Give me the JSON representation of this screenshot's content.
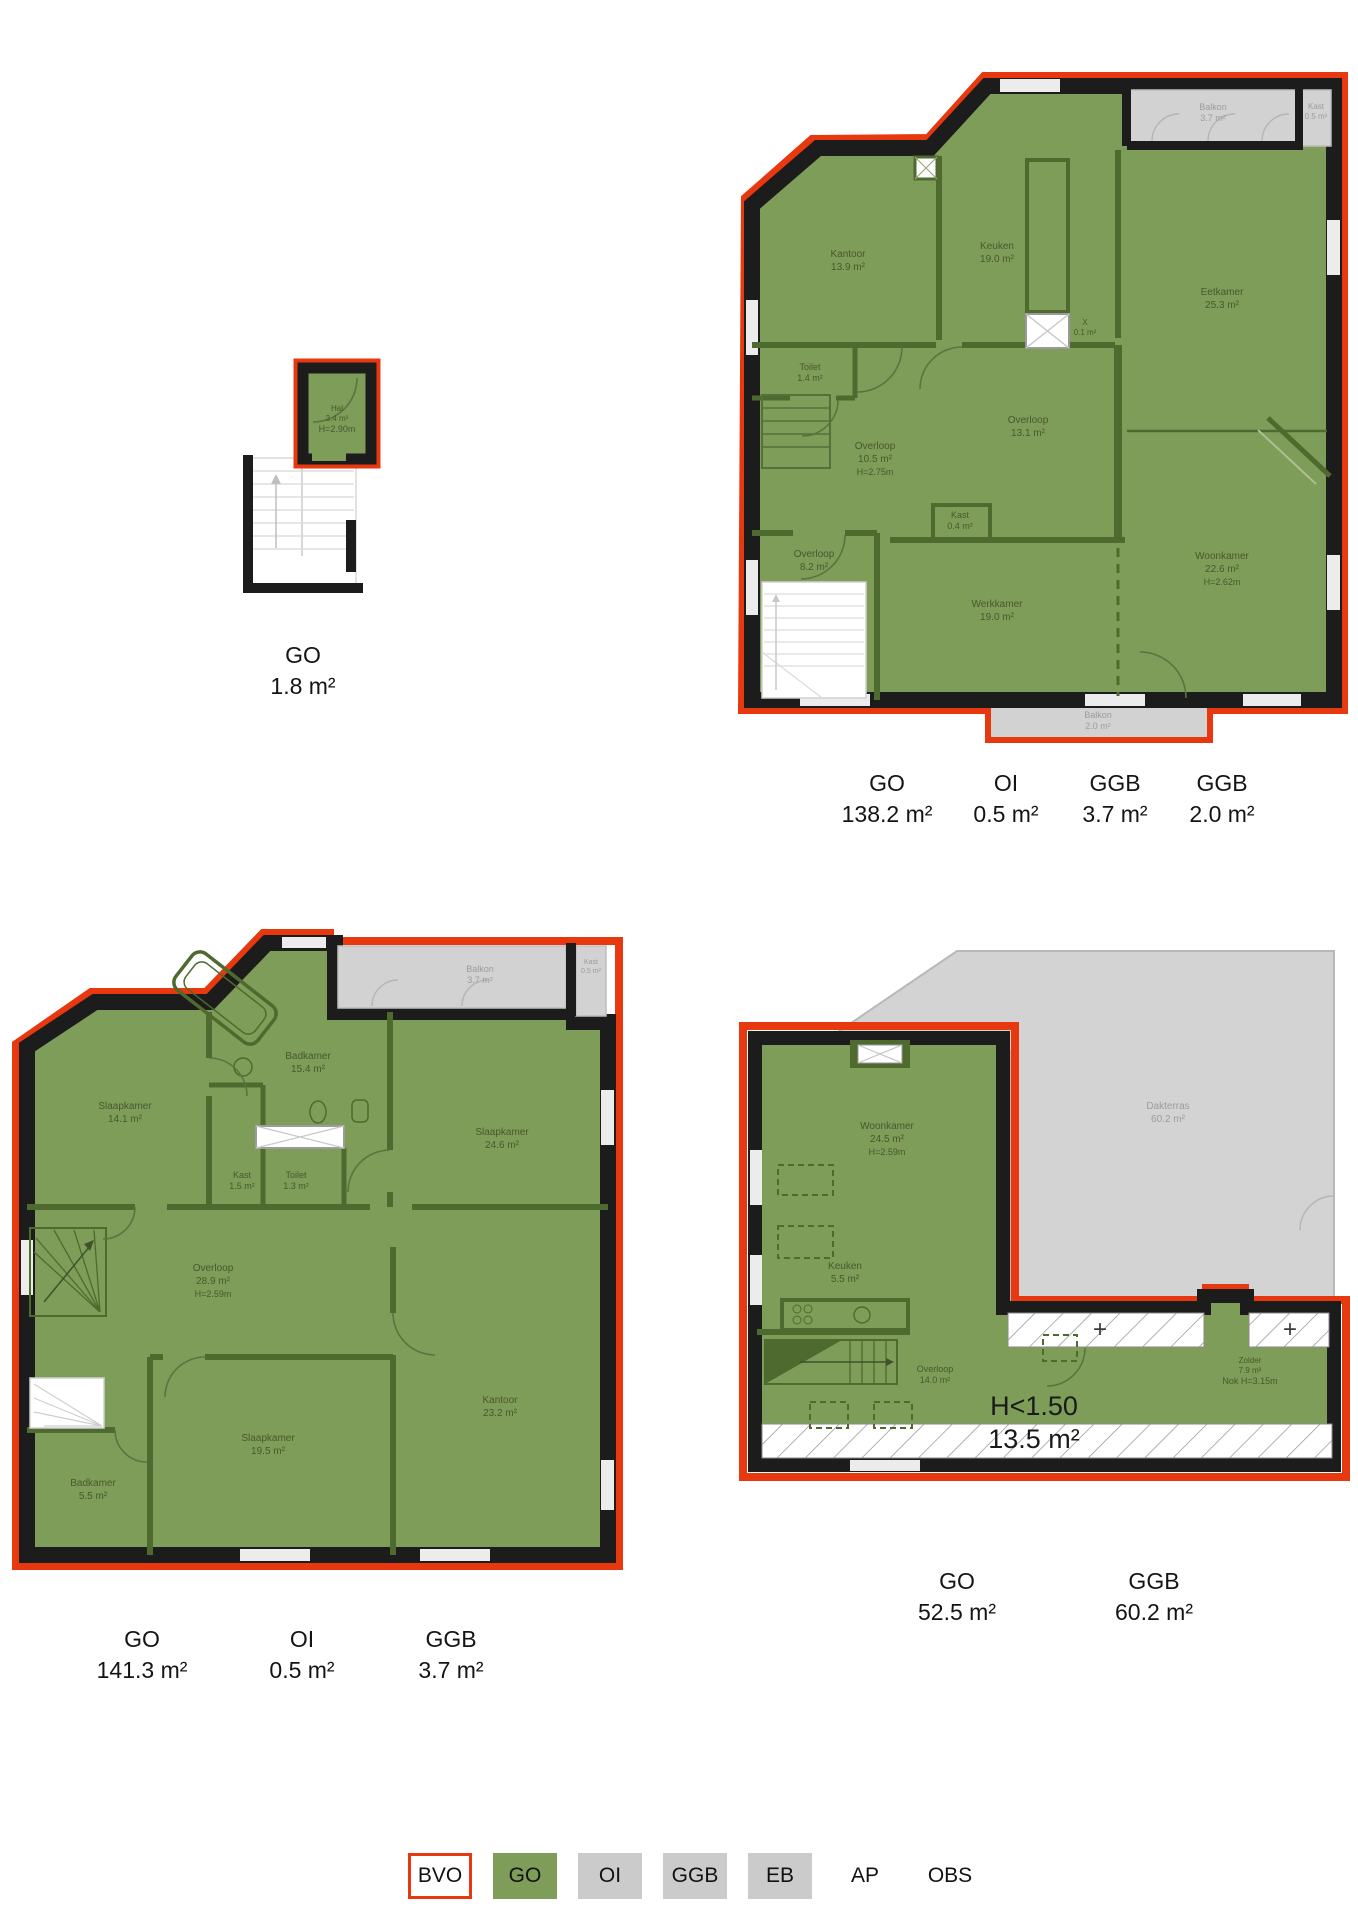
{
  "colors": {
    "bvo_red": "#e8380f",
    "go_green": "#7e9d58",
    "area_gray": "#d2d2d2",
    "wall_black": "#1c1c1c",
    "inner_wall_green": "#4f6a2e",
    "room_text_green": "#49582f",
    "room_text_gray": "#9c9c9c"
  },
  "floor1": {
    "rooms": [
      {
        "name": "Hal",
        "area": "3.4 m²",
        "note": "H=2.90m"
      }
    ],
    "metrics": [
      {
        "label": "GO",
        "value": "1.8 m²"
      }
    ]
  },
  "floor2": {
    "rooms": [
      {
        "name": "Kantoor",
        "area": "13.9 m²"
      },
      {
        "name": "Keuken",
        "area": "19.0 m²"
      },
      {
        "name": "Eetkamer",
        "area": "25.3 m²"
      },
      {
        "name": "Toilet",
        "area": "1.4 m²"
      },
      {
        "name": "Overloop",
        "area": "10.5 m²",
        "note": "H=2.75m"
      },
      {
        "name": "Overloop",
        "area": "13.1 m²"
      },
      {
        "name": "Kast",
        "area": "0.4 m²"
      },
      {
        "name": "Overloop",
        "area": "8.2 m²"
      },
      {
        "name": "Werkkamer",
        "area": "19.0 m²"
      },
      {
        "name": "Woonkamer",
        "area": "22.6 m²",
        "note": "H=2.62m"
      },
      {
        "name": "X",
        "area": "0.1 m²"
      }
    ],
    "outdoor": [
      {
        "name": "Balkon",
        "area": "3.7 m²"
      },
      {
        "name": "Kast",
        "area": "0.5 m²"
      },
      {
        "name": "Balkon",
        "area": "2.0 m²"
      }
    ],
    "metrics": [
      {
        "label": "GO",
        "value": "138.2 m²"
      },
      {
        "label": "OI",
        "value": "0.5 m²"
      },
      {
        "label": "GGB",
        "value": "3.7 m²"
      },
      {
        "label": "GGB",
        "value": "2.0 m²"
      }
    ]
  },
  "floor3": {
    "rooms": [
      {
        "name": "Slaapkamer",
        "area": "14.1 m²"
      },
      {
        "name": "Badkamer",
        "area": "15.4 m²"
      },
      {
        "name": "Kast",
        "area": "1.5 m²"
      },
      {
        "name": "Toilet",
        "area": "1.3 m²"
      },
      {
        "name": "Slaapkamer",
        "area": "24.6 m²"
      },
      {
        "name": "Overloop",
        "area": "28.9 m²",
        "note": "H=2.59m"
      },
      {
        "name": "Slaapkamer",
        "area": "19.5 m²"
      },
      {
        "name": "Badkamer",
        "area": "5.5 m²"
      },
      {
        "name": "Kantoor",
        "area": "23.2 m²"
      }
    ],
    "outdoor": [
      {
        "name": "Balkon",
        "area": "3.7 m²"
      },
      {
        "name": "Kast",
        "area": "0.5 m²"
      }
    ],
    "metrics": [
      {
        "label": "GO",
        "value": "141.3 m²"
      },
      {
        "label": "OI",
        "value": "0.5 m²"
      },
      {
        "label": "GGB",
        "value": "3.7 m²"
      }
    ]
  },
  "floor4": {
    "rooms": [
      {
        "name": "Woonkamer",
        "area": "24.5 m²",
        "note": "H=2.59m"
      },
      {
        "name": "Keuken",
        "area": "5.5 m²"
      },
      {
        "name": "Overloop",
        "area": "14.0 m²"
      },
      {
        "name": "Zolder",
        "area": "7.9 m²",
        "note": "Nok H=3.15m"
      }
    ],
    "outdoor": [
      {
        "name": "Dakterras",
        "area": "60.2 m²"
      }
    ],
    "low_height": {
      "label": "H<1.50",
      "value": "13.5 m²"
    },
    "plus": "+",
    "metrics": [
      {
        "label": "GO",
        "value": "52.5 m²"
      },
      {
        "label": "GGB",
        "value": "60.2 m²"
      }
    ]
  },
  "legend": {
    "items": [
      {
        "label": "BVO"
      },
      {
        "label": "GO"
      },
      {
        "label": "OI"
      },
      {
        "label": "GGB"
      },
      {
        "label": "EB"
      },
      {
        "label": "AP"
      },
      {
        "label": "OBS"
      }
    ]
  }
}
